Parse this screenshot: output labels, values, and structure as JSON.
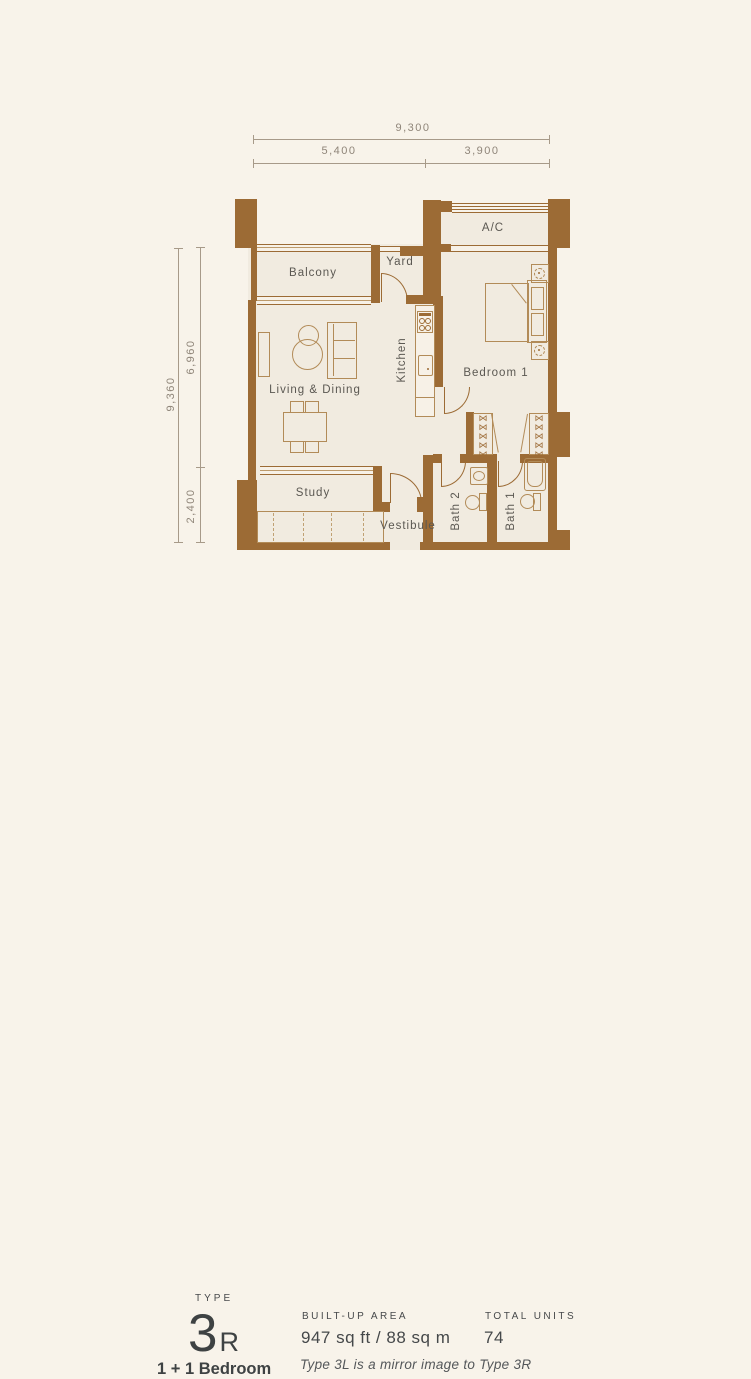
{
  "plan": {
    "rooms": {
      "balcony": "Balcony",
      "yard": "Yard",
      "ac": "A/C",
      "kitchen": "Kitchen",
      "living": "Living & Dining",
      "bedroom": "Bedroom 1",
      "study": "Study",
      "vestibule": "Vestibule",
      "bath2": "Bath 2",
      "bath1": "Bath 1"
    },
    "dimensions": {
      "width_total": "9,300",
      "width_left": "5,400",
      "width_right": "3,900",
      "height_total": "9,360",
      "height_upper": "6,960",
      "height_lower": "2,400"
    },
    "icons": {
      "hanger_glyph": "⋈"
    },
    "colors": {
      "wall": "#9c6b35",
      "furniture_line": "#b28b58",
      "room_fill": "#f1ebe0",
      "background": "#f8f3ea",
      "label_text": "#5b5852",
      "dimension_text": "#8f8579"
    }
  },
  "info": {
    "type_label": "TYPE",
    "type_number": "3",
    "type_suffix": "R",
    "bedroom_config": "1 + 1 Bedroom",
    "built_up_area_label": "BUILT-UP AREA",
    "built_up_area_value": "947 sq ft / 88 sq m",
    "total_units_label": "TOTAL UNITS",
    "total_units_value": "74",
    "mirror_note": "Type 3L is a mirror image to Type 3R"
  }
}
